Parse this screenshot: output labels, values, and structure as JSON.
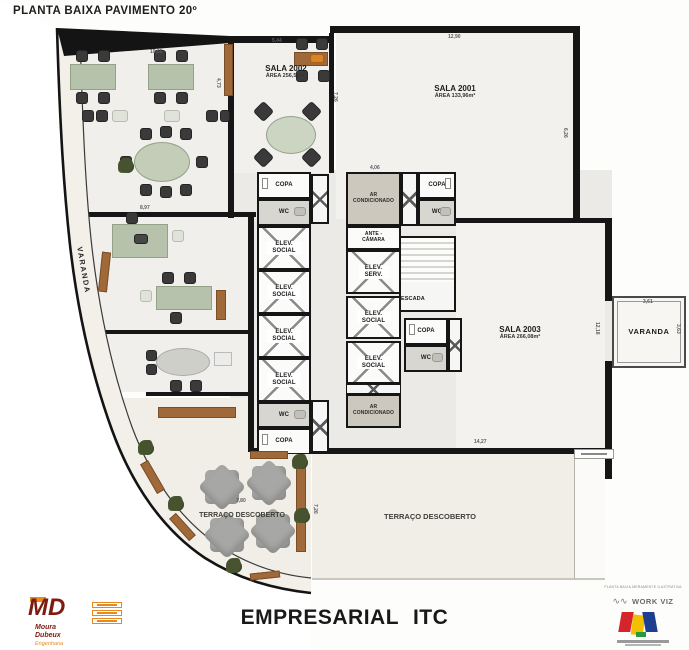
{
  "title": "PLANTA BAIXA PAVIMENTO 20º",
  "footer": {
    "project": "EMPRESARIAL ITC"
  },
  "rooms": {
    "sala_2001": {
      "name": "SALA 2001",
      "area": "ÁREA 133,96m²"
    },
    "sala_2002": {
      "name": "SALA 2002",
      "area": "ÁREA 256,59m²"
    },
    "sala_2003": {
      "name": "SALA 2003",
      "area": "ÁREA 266,08m²"
    },
    "copa": "COPA",
    "wc": "WC",
    "elev_social": "ELEV. SOCIAL",
    "elev_serv": "ELEV. SERV.",
    "ante_camara": "ANTE - CÂMARA",
    "escada": "ESCADA",
    "ar_condicionado": "AR CONDICIONADO",
    "varanda": "VARANDA",
    "terraco": "TERRAÇO DESCOBERTO"
  },
  "dims": [
    {
      "t": "10,65"
    },
    {
      "t": "5,44"
    },
    {
      "t": "12,90"
    },
    {
      "t": "7,26"
    },
    {
      "t": "4,73"
    },
    {
      "t": "8,97"
    },
    {
      "t": "6,26"
    },
    {
      "t": "4,06"
    },
    {
      "t": "3,61"
    },
    {
      "t": "12,18"
    },
    {
      "t": "14,27"
    },
    {
      "t": "7,80"
    },
    {
      "t": "7,26"
    },
    {
      "t": "3,63"
    }
  ],
  "logos": {
    "moura_dubeux": {
      "initials": "MD",
      "name1": "Moura",
      "name2": "Dubeux",
      "name3": "Engenharia"
    },
    "workviz": {
      "caption": "PLANTA BAIXA MERAMENTE ILUSTRATIVA",
      "name": "WORK VIZ"
    }
  },
  "colors": {
    "wall": "#161616",
    "terrace": "#f1eee7",
    "furniture_green": "#b6c2ab",
    "wood": "#a0693a",
    "md_maroon": "#7e1b10",
    "md_orange": "#e8891f"
  }
}
